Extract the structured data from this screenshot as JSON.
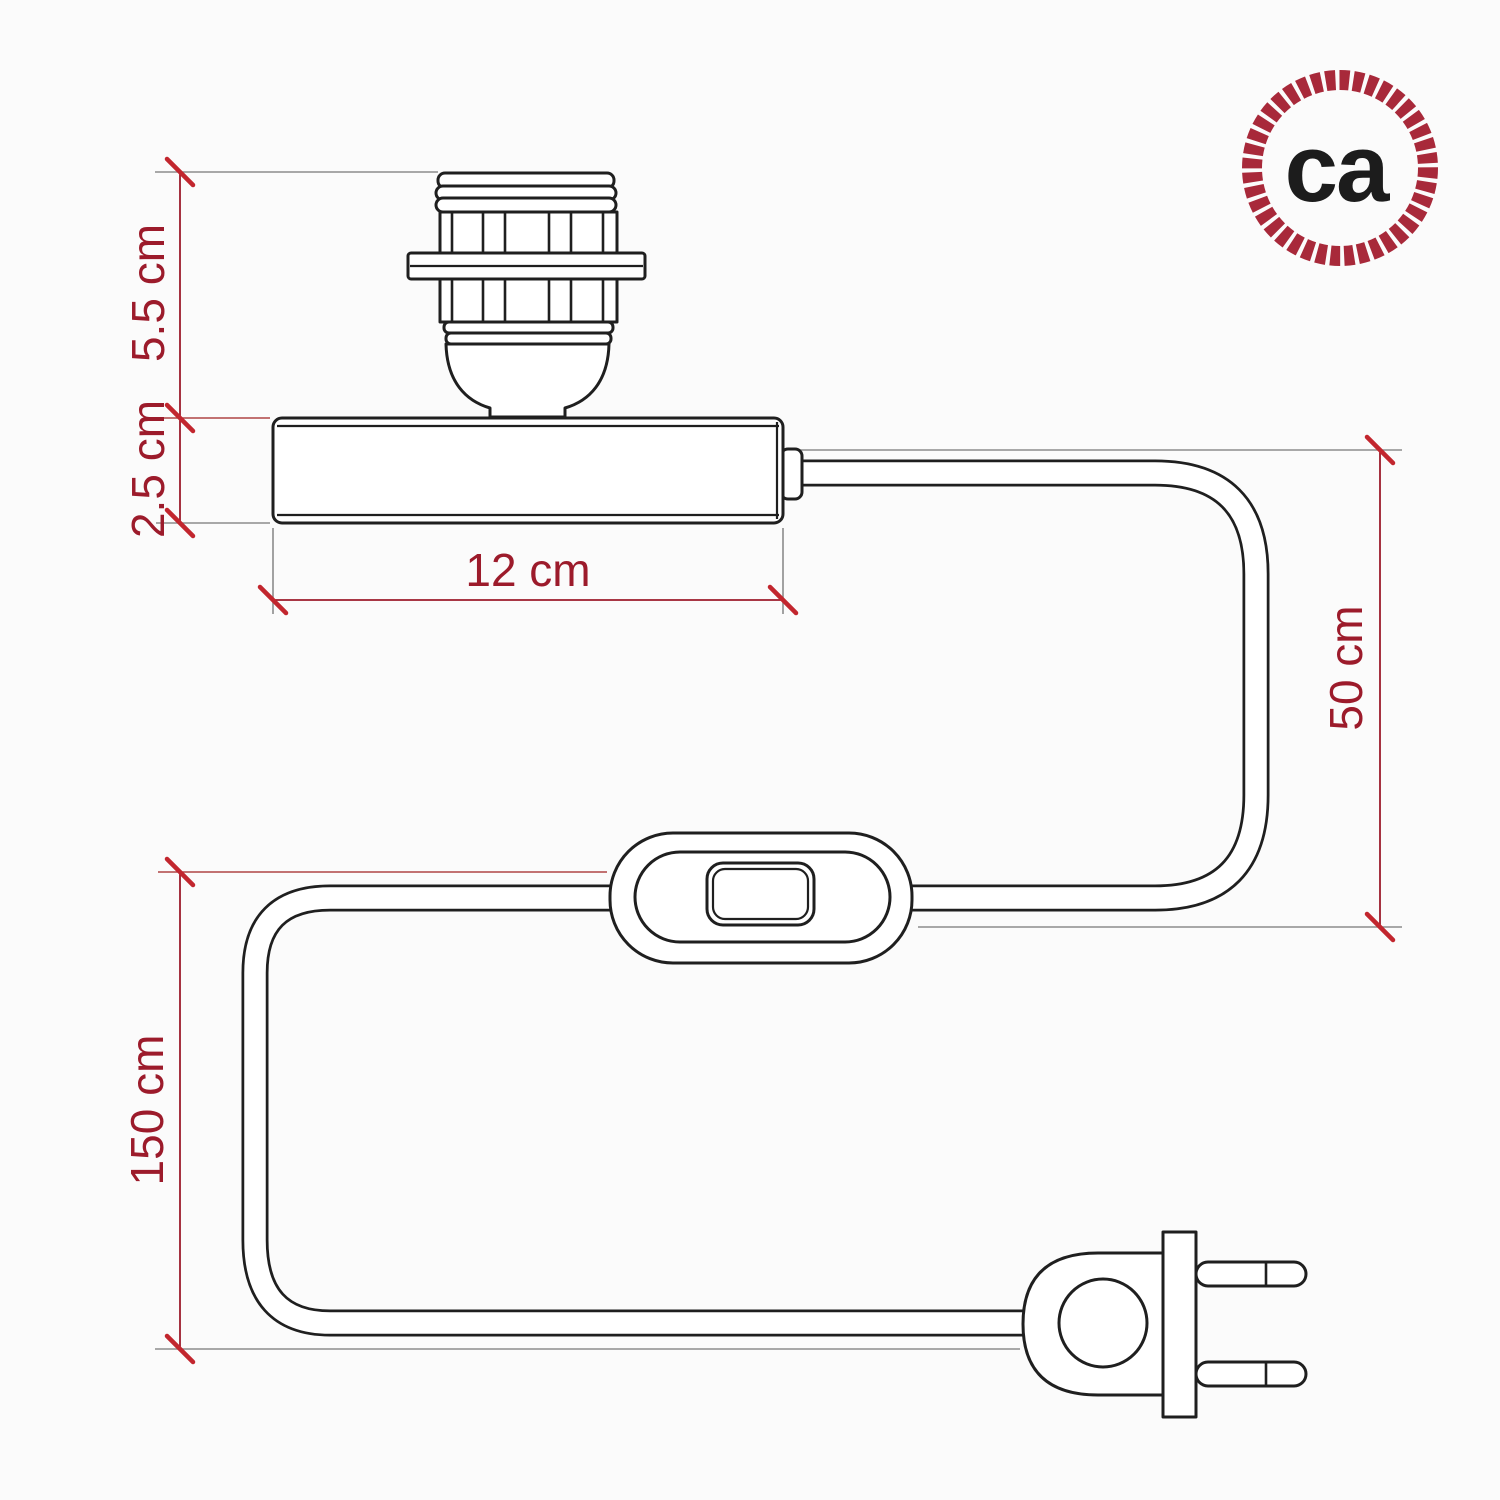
{
  "page": {
    "background": "#fbfbfb"
  },
  "logo": {
    "text": "ca",
    "rope_color": "#a8293a",
    "text_color": "#1c1c1c"
  },
  "diagram": {
    "colors": {
      "linework": "#1f1f1f",
      "dimension": "#9c1b2b",
      "tick": "#c2262e",
      "extension": "#8c8c8c",
      "extension_red": "#b04545"
    },
    "dimensions": {
      "socket_height": {
        "label": "5.5 cm"
      },
      "base_height": {
        "label": "2.5 cm"
      },
      "base_width": {
        "label": "12 cm"
      },
      "cable_rise": {
        "label": "50 cm"
      },
      "cable_length": {
        "label": "150 cm"
      }
    }
  }
}
